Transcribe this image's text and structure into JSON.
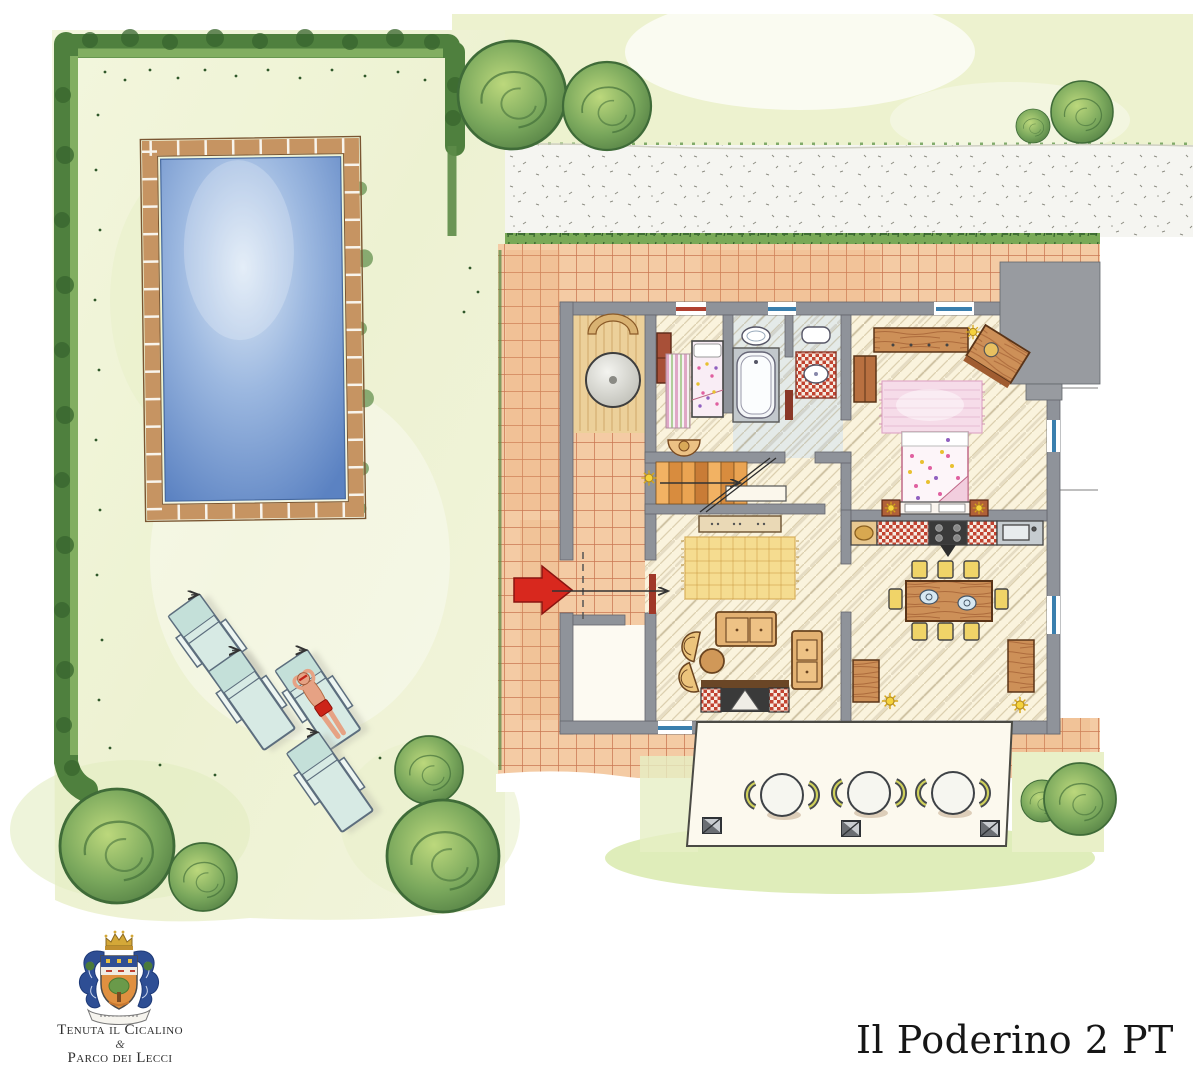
{
  "title": {
    "text": "Il Poderino 2 PT"
  },
  "logo": {
    "estate": "Tenuta il Cicalino",
    "ampersand": "&",
    "park": "Parco dei Lecci"
  },
  "colors": {
    "paper": "#ffffff",
    "lawn": "#eff3d6",
    "hedge_green": "#4f803e",
    "bush_green": "#6a9a55",
    "gravel": "#f5f5f1",
    "terracotta_tile": "#f4cba4",
    "tile_joint": "#bb5a38",
    "pool_water": "#6f94cf",
    "pool_coping": "#c69462",
    "house_wall": "#8f939a",
    "floor_cream": "#faf3dd",
    "bathroom_floor": "#e4eae8",
    "entry_arrow_red": "#d8281e",
    "window_blue": "#3a7fae",
    "door_red": "#a03828",
    "wood_furniture": "#cd9058",
    "chair_yellow": "#f0d468",
    "lounger_mint": "#d7eae4",
    "rug_yellow": "#f5dc90",
    "rug_pink": "#f6dce9",
    "lamp_yellow": "#f5d23c"
  },
  "inventory": {
    "sun_loungers": 4,
    "sunbathers": 1,
    "terrace_tables": 3,
    "terrace_chairs": 6,
    "pergola_posts": 3,
    "dining_chairs": 8,
    "trees_and_bushes": 10,
    "swimming_pools": 1
  }
}
